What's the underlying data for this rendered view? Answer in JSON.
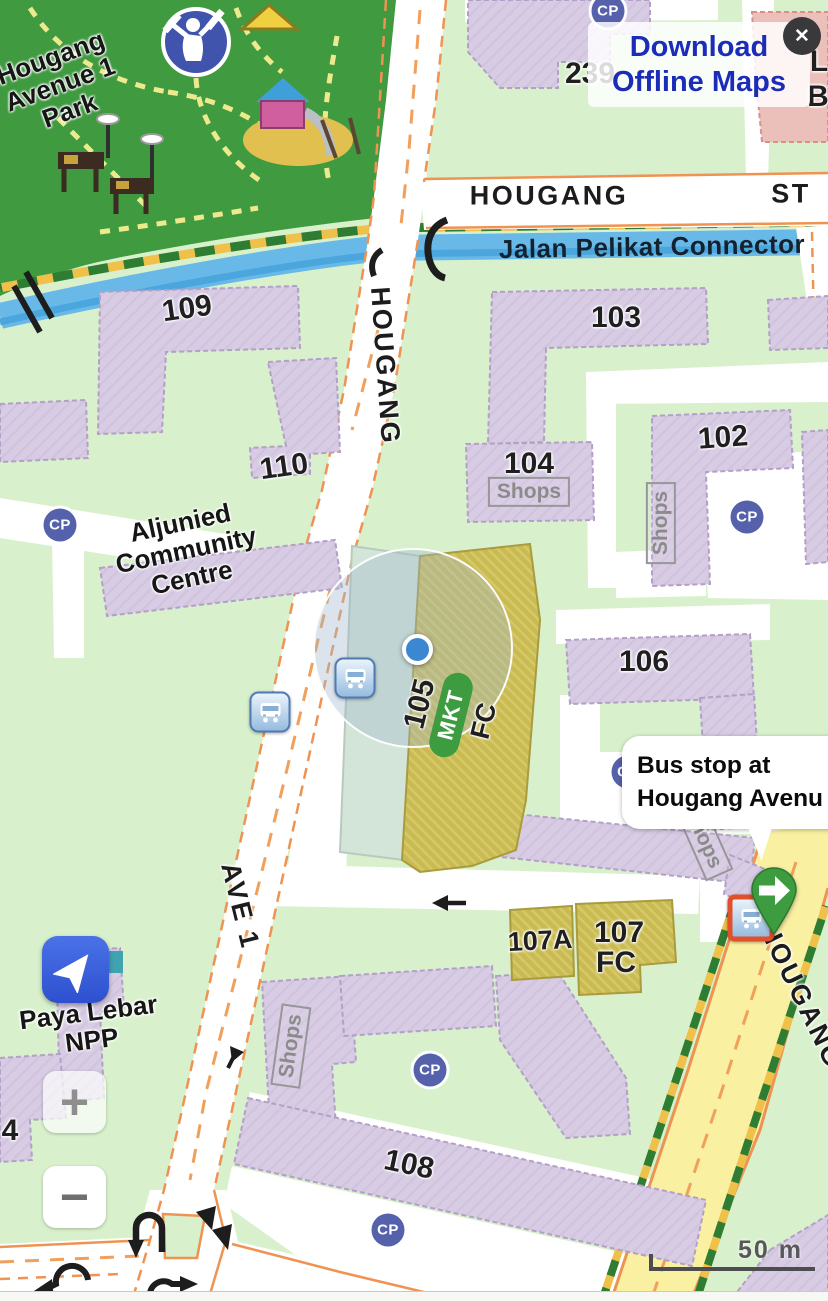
{
  "banner": {
    "line1": "Download",
    "line2": "Offline Maps",
    "close_glyph": "✕"
  },
  "tooltip": {
    "line1": "Bus stop at",
    "line2": "Hougang Avenu"
  },
  "controls": {
    "zoom_in": "+",
    "zoom_out": "−"
  },
  "scale_bar": {
    "label": "50 m"
  },
  "colors": {
    "accent_blue": "#1b2cb8",
    "button_blue": "#3a5ed9",
    "pin_green": "#3d9b40",
    "selected_red": "#e0502b",
    "road_orange": "#ef9352",
    "canal_blue": "#62b7e8",
    "building_lavender": "#d6cbe3",
    "building_khaki": "#c9ba52",
    "park_green": "#3f9a40",
    "land_green": "#d8f1cc"
  },
  "map": {
    "street_labels": [
      {
        "label": "HOUGANG",
        "x": 549,
        "y": 196,
        "rot": 0
      },
      {
        "label": "ST",
        "x": 791,
        "y": 194,
        "rot": 0
      },
      {
        "label": "HOUGANG",
        "x": 385,
        "y": 366,
        "rot": 86
      },
      {
        "label": "AVE 1",
        "x": 240,
        "y": 906,
        "rot": 76
      },
      {
        "label": "HOUGANG",
        "x": 801,
        "y": 996,
        "rot": 64
      }
    ],
    "waterway_label": {
      "label": "Jalan Pelikat Connector",
      "x": 652,
      "y": 247,
      "rot": -1
    },
    "building_labels": [
      {
        "label": "239",
        "x": 590,
        "y": 74,
        "rot": 0
      },
      {
        "label": "109",
        "x": 187,
        "y": 309,
        "rot": -8
      },
      {
        "label": "103",
        "x": 616,
        "y": 318,
        "rot": 0
      },
      {
        "label": "110",
        "x": 284,
        "y": 467,
        "rot": -8
      },
      {
        "label": "104",
        "x": 529,
        "y": 464,
        "rot": 0
      },
      {
        "label": "102",
        "x": 723,
        "y": 438,
        "rot": -4
      },
      {
        "label": "106",
        "x": 644,
        "y": 662,
        "rot": 0
      },
      {
        "label": "105",
        "x": 420,
        "y": 704,
        "rot": -76
      },
      {
        "label": "107A",
        "x": 540,
        "y": 941,
        "rot": -3,
        "size": 27
      },
      {
        "label": "107",
        "x": 619,
        "y": 933,
        "rot": 0
      },
      {
        "label": "FC",
        "x": 616,
        "y": 963,
        "rot": 0
      },
      {
        "label": "108",
        "x": 409,
        "y": 1165,
        "rot": 12
      },
      {
        "label": "4",
        "x": 10,
        "y": 1131,
        "rot": 0
      },
      {
        "label": "L",
        "x": 819,
        "y": 62,
        "rot": 0
      },
      {
        "label": "B",
        "x": 818,
        "y": 97,
        "rot": 0
      }
    ],
    "area_labels": [
      {
        "label": "Hougang\nAvenue 1\nPark",
        "x": 60,
        "y": 84,
        "rot": -20
      },
      {
        "label": "Aljunied\nCommunity\nCentre",
        "x": 186,
        "y": 550,
        "rot": -12
      },
      {
        "label": "Paya Lebar\nNPP",
        "x": 90,
        "y": 1026,
        "rot": -7
      }
    ],
    "shops_labels": [
      {
        "label": "Shops",
        "x": 529,
        "y": 492,
        "rot": 0
      },
      {
        "label": "Shops",
        "x": 661,
        "y": 523,
        "rot": -90
      },
      {
        "label": "Shops",
        "x": 291,
        "y": 1046,
        "rot": -82
      },
      {
        "label": "Shops",
        "x": 703,
        "y": 838,
        "rot": 66
      }
    ],
    "market_badge": {
      "label": "MKT",
      "x": 451,
      "y": 715,
      "rot": -76
    },
    "market_fc_label": {
      "label": "FC",
      "x": 484,
      "y": 721,
      "rot": -76
    },
    "carpark_icons": [
      {
        "label": "CP",
        "x": 608,
        "y": 11
      },
      {
        "label": "CP",
        "x": 60,
        "y": 525
      },
      {
        "label": "CP",
        "x": 747,
        "y": 517
      },
      {
        "label": "CP",
        "x": 628,
        "y": 772
      },
      {
        "label": "CP",
        "x": 430,
        "y": 1070
      },
      {
        "label": "CP",
        "x": 388,
        "y": 1230
      }
    ],
    "bus_stops": [
      {
        "x": 355,
        "y": 678
      },
      {
        "x": 270,
        "y": 712
      },
      {
        "x": 751,
        "y": 918,
        "cls": "selected"
      }
    ]
  }
}
